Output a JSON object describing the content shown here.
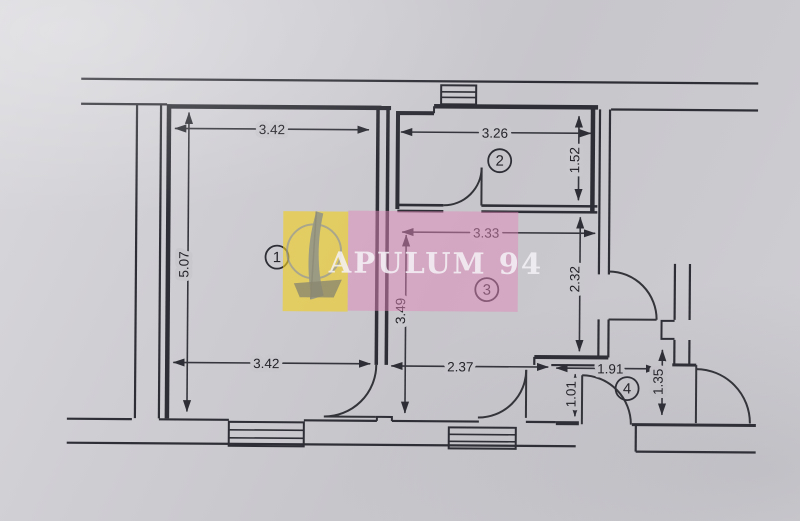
{
  "watermark": {
    "text": "APULUM 94",
    "colors": {
      "yellow": "#f0cf1e",
      "pink": "#e087b8",
      "text": "#f5f2f7"
    }
  },
  "paper_color": "#cac9ce",
  "ink_color": "#2e2e36",
  "rooms": [
    {
      "number": "1"
    },
    {
      "number": "2"
    },
    {
      "number": "3"
    },
    {
      "number": "4"
    }
  ],
  "dimensions": {
    "room1_width_top": "3.42",
    "room1_height_left": "5.07",
    "room1_width_bottom": "3.42",
    "room2_width": "3.26",
    "room2_height": "1.52",
    "room3_width": "3.33",
    "room3_height_left": "3.49",
    "room3_height_right": "2.32",
    "room3_width_bottom": "2.37",
    "room4_width": "1.91",
    "corridor_height": "1.01",
    "room4_height": "1.35"
  }
}
